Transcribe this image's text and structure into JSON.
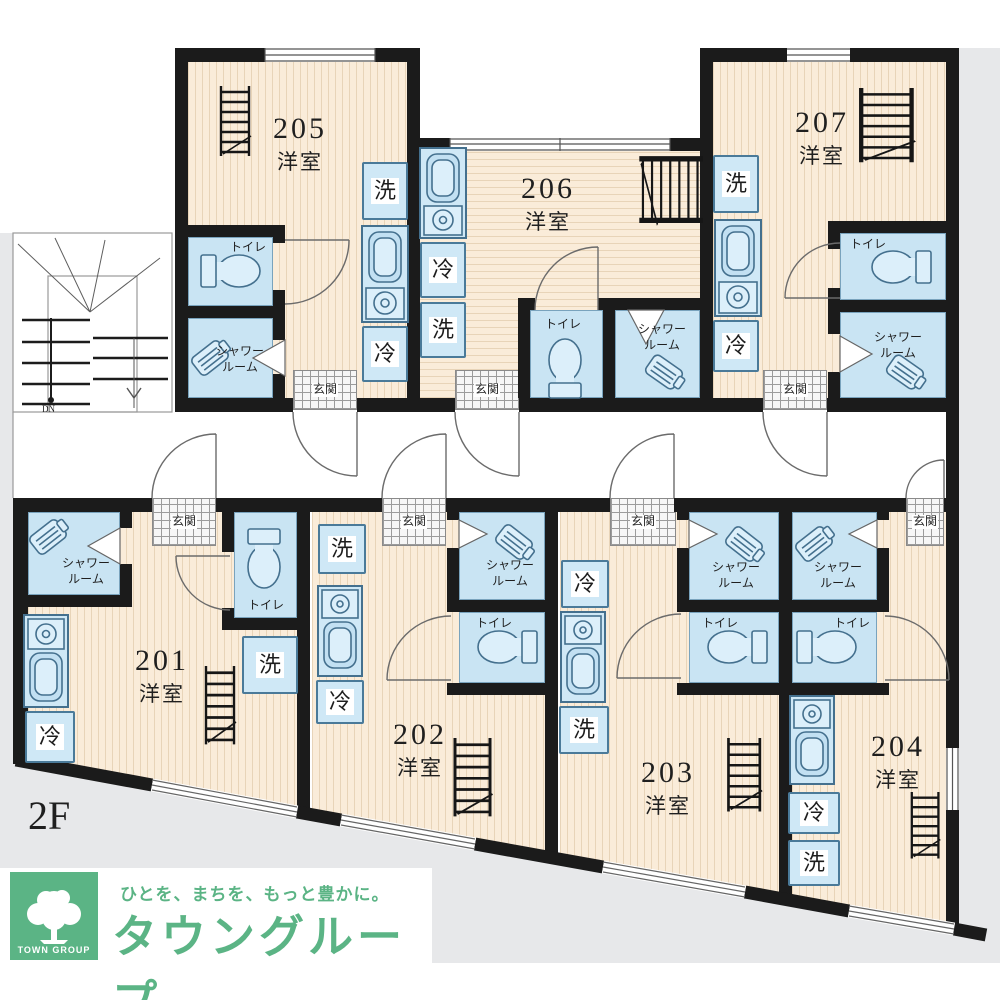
{
  "floor": {
    "label": "2F"
  },
  "stairs": {
    "dn": "DN"
  },
  "labels": {
    "room_type": "洋室",
    "toilet": "トイレ",
    "shower_line1": "シャワー",
    "shower_line2": "ルーム",
    "entrance": "玄関",
    "washer": "洗",
    "fridge": "冷"
  },
  "units": [
    {
      "number": "201",
      "type": "洋室"
    },
    {
      "number": "202",
      "type": "洋室"
    },
    {
      "number": "203",
      "type": "洋室"
    },
    {
      "number": "204",
      "type": "洋室"
    },
    {
      "number": "205",
      "type": "洋室"
    },
    {
      "number": "206",
      "type": "洋室"
    },
    {
      "number": "207",
      "type": "洋室"
    }
  ],
  "logo": {
    "tagline": "ひとを、まちを、もっと豊かに。",
    "company": "タウングループ",
    "mark": "TOWN GROUP"
  },
  "icons": {
    "stairs": "staircase-icon",
    "loft_ladder": "loft-ladder-icon",
    "toilet": "toilet-icon",
    "shower": "shower-head-icon",
    "kitchen": "kitchen-sink-stove-icon",
    "window": "window-glyph",
    "door": "door-swing-arc",
    "tree": "tree-icon"
  },
  "colors": {
    "wall": "#1b1b1b",
    "floor_fill": "#faecd9",
    "wet_fill": "#c9e4f3",
    "fixture_border": "#4a7a99",
    "brand_green": "#5bb485",
    "exterior_gray": "#e7e8ea"
  }
}
